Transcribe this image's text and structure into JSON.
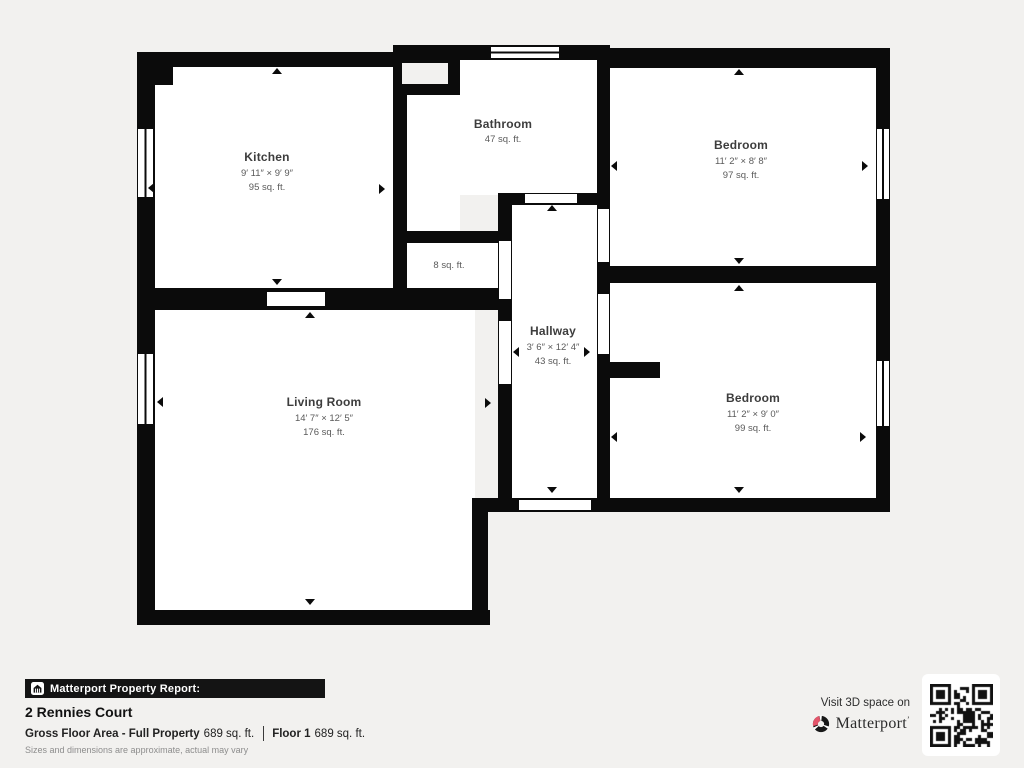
{
  "palette": {
    "background": "#f2f1ef",
    "wall": "#0b0b0b",
    "brand_pink": "#e3556a"
  },
  "rooms": [
    {
      "id": "kitchen",
      "name": "Kitchen",
      "dimensions": "9′ 11″ × 9′ 9″",
      "area": "95 sq. ft."
    },
    {
      "id": "bathroom",
      "name": "Bathroom",
      "dimensions": "",
      "area": "47 sq. ft."
    },
    {
      "id": "bedroom-1",
      "name": "Bedroom",
      "dimensions": "11′ 2″ × 8′ 8″",
      "area": "97 sq. ft."
    },
    {
      "id": "closet",
      "name": "",
      "dimensions": "",
      "area": "8 sq. ft."
    },
    {
      "id": "hallway",
      "name": "Hallway",
      "dimensions": "3′ 6″ × 12′ 4″",
      "area": "43 sq. ft."
    },
    {
      "id": "living-room",
      "name": "Living Room",
      "dimensions": "14′ 7″ × 12′ 5″",
      "area": "176 sq. ft."
    },
    {
      "id": "bedroom-2",
      "name": "Bedroom",
      "dimensions": "11′ 2″ × 9′ 0″",
      "area": "99 sq. ft."
    }
  ],
  "footer": {
    "report_label": "Matterport Property Report:",
    "property_name": "2 Rennies Court",
    "gross_floor_area_label": "Gross Floor Area - Full Property",
    "gross_floor_area_value": "689 sq. ft.",
    "floor_label": "Floor 1",
    "floor_value": "689 sq. ft.",
    "disclaimer": "Sizes and dimensions are approximate, actual may vary"
  },
  "branding": {
    "visit_text": "Visit 3D space on",
    "brand_name": "Matterport",
    "brand_trademark": "’"
  }
}
